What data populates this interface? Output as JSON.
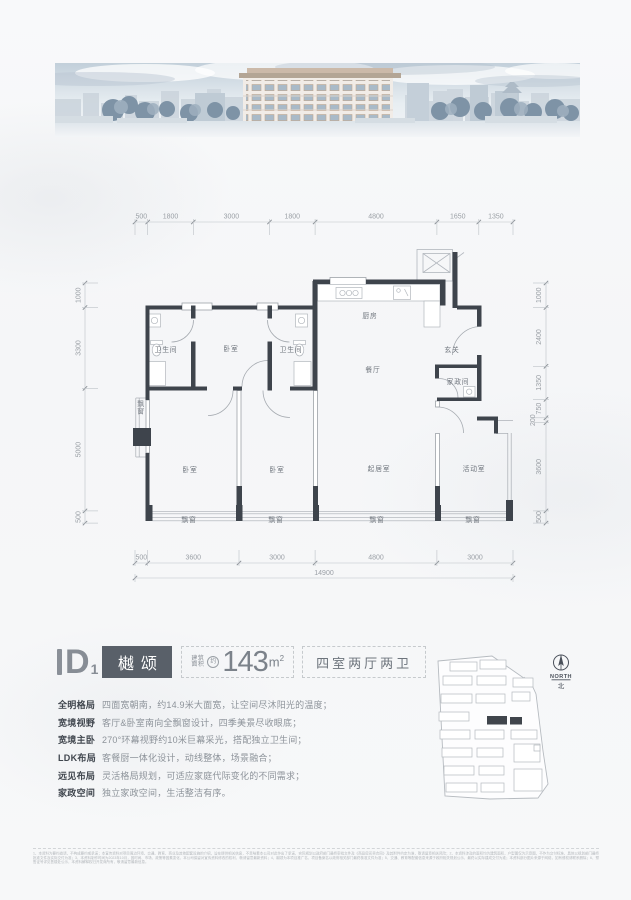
{
  "colors": {
    "wall": "#3e444c",
    "line_light": "#b2b7bd",
    "dim_line": "#bcc1c6",
    "dim_text": "#9ba0a6",
    "name_box_bg": "#596069",
    "accent_gray": "#878d95"
  },
  "title": {
    "d": "D",
    "sub": "1",
    "name": "樾颂",
    "area_label_1": "建筑",
    "area_label_2": "面积",
    "area_approx": "约",
    "area_value": "143",
    "area_unit_base": "m",
    "area_unit_sup": "2",
    "layout": "四室两厅两卫"
  },
  "features": [
    {
      "label": "全明格局",
      "desc": "四面宽朝南，约14.9米大面宽，让空间尽沐阳光的温度；"
    },
    {
      "label": "宽境视野",
      "desc": "客厅&卧室南向全飘窗设计，四季美景尽收眼底；"
    },
    {
      "label": "宽境主卧",
      "desc": "270°环幕视野约10米巨幕采光，搭配独立卫生间；"
    },
    {
      "label": "LDK布局",
      "desc": "客餐厨一体化设计，动线整体，场景融合；"
    },
    {
      "label": "远见布局",
      "desc": "灵活格局规划，可适应家庭代际变化的不同需求；"
    },
    {
      "label": "家政空间",
      "desc": "独立家政空间，生活整洁有序。"
    }
  ],
  "compass": {
    "north": "NORTH",
    "cn": "北"
  },
  "plan": {
    "rooms": [
      {
        "name": "卫生间",
        "x": 166,
        "y": 352
      },
      {
        "name": "卧室",
        "x": 231,
        "y": 351
      },
      {
        "name": "卫生间",
        "x": 291,
        "y": 352
      },
      {
        "name": "厨房",
        "x": 370,
        "y": 318
      },
      {
        "name": "餐厅",
        "x": 373,
        "y": 372
      },
      {
        "name": "玄关",
        "x": 452,
        "y": 352
      },
      {
        "name": "家政间",
        "x": 458,
        "y": 384
      },
      {
        "name": "卧室",
        "x": 190,
        "y": 472
      },
      {
        "name": "卧室",
        "x": 277,
        "y": 472
      },
      {
        "name": "起居室",
        "x": 379,
        "y": 471
      },
      {
        "name": "活动室",
        "x": 474,
        "y": 471
      },
      {
        "name": "飘窗",
        "x": 189,
        "y": 522
      },
      {
        "name": "飘窗",
        "x": 276,
        "y": 522
      },
      {
        "name": "飘窗",
        "x": 377,
        "y": 522
      },
      {
        "name": "飘窗",
        "x": 473,
        "y": 522
      },
      {
        "name": "飘窗",
        "x": 141,
        "y": 406,
        "vertical": true
      }
    ],
    "dims": {
      "top": {
        "o": "h",
        "y": 222,
        "x1": 135,
        "x2": 513,
        "ext": 1,
        "labelY": 218.5,
        "ticks": [
          135,
          147.7,
          193.3,
          269.5,
          315.1,
          436.9,
          478.8,
          513
        ],
        "labels": [
          {
            "t": "500",
            "x": 141.3
          },
          {
            "t": "1800",
            "x": 170.5
          },
          {
            "t": "3000",
            "x": 231.4
          },
          {
            "t": "1800",
            "x": 292.3
          },
          {
            "t": "4800",
            "x": 376
          },
          {
            "t": "1650",
            "x": 457.8
          },
          {
            "t": "1350",
            "x": 495.9
          }
        ]
      },
      "bottom": {
        "o": "h",
        "y": 563,
        "x1": 135,
        "x2": 513,
        "ext": -1,
        "labelY": 559.5,
        "ticks": [
          135,
          147.7,
          239,
          315.1,
          436.9,
          513
        ],
        "labels": [
          {
            "t": "500",
            "x": 141.3
          },
          {
            "t": "3600",
            "x": 193.3
          },
          {
            "t": "3000",
            "x": 277
          },
          {
            "t": "4800",
            "x": 376
          },
          {
            "t": "3000",
            "x": 475
          }
        ]
      },
      "total": {
        "o": "h",
        "y": 578,
        "x1": 135,
        "x2": 513,
        "ext": 0,
        "labelY": 575,
        "ticks": [
          135,
          513
        ],
        "labels": [
          {
            "t": "14900",
            "x": 324
          }
        ]
      },
      "left": {
        "o": "v",
        "x": 85,
        "y1": 283,
        "y2": 523.1,
        "ext": 1,
        "labelX": 80.5,
        "ticks": [
          283,
          307.5,
          388.4,
          510.9,
          523.1
        ],
        "labels": [
          {
            "t": "1000",
            "y": 295.2
          },
          {
            "t": "3300",
            "y": 348
          },
          {
            "t": "5000",
            "y": 449.6
          },
          {
            "t": "500",
            "y": 517
          }
        ]
      },
      "right": {
        "o": "v",
        "x": 546,
        "y1": 283,
        "y2": 523.1,
        "ext": -1,
        "labelX": 541,
        "ticks": [
          283,
          307.5,
          366.3,
          399.4,
          417.8,
          422.7,
          510.9,
          523.1
        ],
        "labels": [
          {
            "t": "1000",
            "y": 295.2
          },
          {
            "t": "2400",
            "y": 337
          },
          {
            "t": "1350",
            "y": 382.8
          },
          {
            "t": "750",
            "y": 408.6
          },
          {
            "t": "200",
            "y": 420.2,
            "dx": -6
          },
          {
            "t": "3600",
            "y": 466.8
          },
          {
            "t": "500",
            "y": 517
          }
        ]
      }
    }
  },
  "disclaimer": {
    "text": "1、本资料为要约邀请，不构成要约或承诺；本宣传资料对项目周边环境、交通、教育、商业及其他配套设施的介绍，旨在提供相关信息，不意味着本公司对此作出了承诺，实际规划以政府部门最终审批文件及《商品房买卖合同》及其附件约定为准，敬请留意相关风险；2、本资料涉及的面积均为建筑面积，户型图仅为示意图，不作为交付标准，具体以规划部门最终批准文件及实际交付为准；3、本资料制作时间为2023年10月，因时间、市场、政策等因素变化，本公司保留对宣传资料修改的权利，敬请留意最新资料；4、樾颂为本项目推广名，项目备案名以政府相关部门最终核准文件为准；5、交通、教育等配套信息来源于政府相关规划公示，最终以实际建成交付为准；本资料部分图片来源于网络，如有侵权请联系删除；6、预售证号详见售楼处公示，本资料解释权归开发商所有，敬请留意最新信息。"
  }
}
